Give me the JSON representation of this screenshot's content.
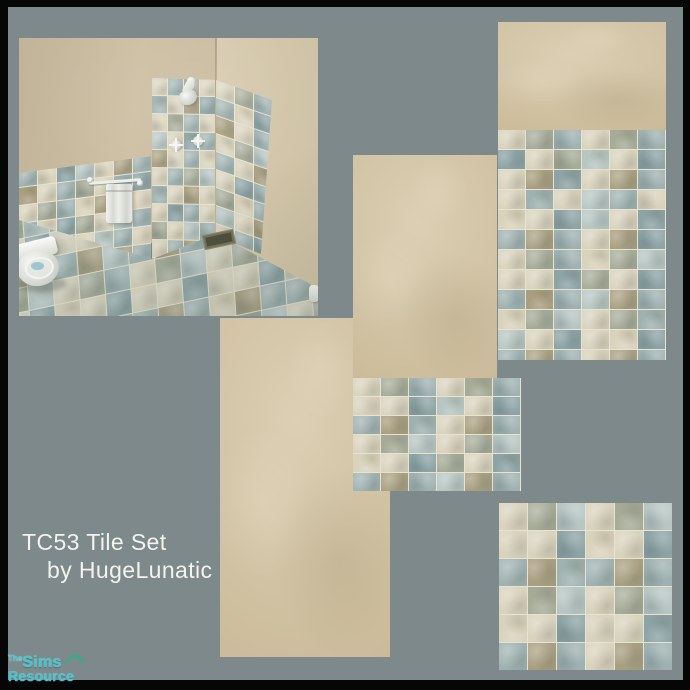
{
  "card": {
    "background_color": "#7d898a",
    "border_color": "#060606"
  },
  "title": {
    "line1": "TC53 Tile Set",
    "line2": "by HugeLunatic",
    "color": "#f3f3f0"
  },
  "logo": {
    "prefix": "The",
    "brand": "Sims",
    "suffix": "Resource",
    "text_color": "#3fc6d2",
    "roof_color": "#2fae8c"
  },
  "palette": {
    "c": "#d9d2bc",
    "b": "#9fb2b1",
    "o": "#a99f80",
    "l": "#b7c6c3",
    "d": "#8da3a5",
    "g": "#a6ab98",
    "grout": "#e7e3d3",
    "wall_beige": "#d2c4a5",
    "fixture_white": "#f0f1ee",
    "water_blue": "#9ec7ce",
    "drain_olive": "#75735a"
  },
  "tiles": {
    "wall": {
      "tile_w": 27,
      "tile_h": 19,
      "rows": [
        "cgbcgb",
        "dcglcd",
        "codcob",
        "cbclbc",
        "ccdlcd",
        "bobcod",
        "cgbcgl",
        "ccdgcd",
        "boblob",
        "cglcgb",
        "lcdccd",
        "bobcob"
      ]
    },
    "wall_small": {
      "tile_w": 27,
      "tile_h": 18,
      "rows": [
        "cgbcgb",
        "ccdlcd",
        "bobcob",
        "cglcgl",
        "ccdgcd",
        "boblob"
      ]
    },
    "floor": {
      "tile_w": 28,
      "tile_h": 27,
      "rows": [
        "cglcgl",
        "ccdccd",
        "bobbob",
        "cglcgl",
        "ccdccd",
        "bobcob"
      ]
    },
    "bath_wainscot": {
      "tile_w": 18,
      "tile_h": 17,
      "rows": [
        "cbocgbc",
        "bcdlcob",
        "ocbgcbd",
        "cgbcolc",
        "bcdgclb",
        "cobclbc",
        "gcbdcob"
      ]
    },
    "bath_shower_left": {
      "tile_w": 15,
      "tile_h": 17,
      "rows": [
        "cbgc",
        "bcod",
        "cgbc",
        "lcdb",
        "ocbc",
        "cbgl",
        "bcoc",
        "cdbc",
        "gclb",
        "cboc",
        "bgcd"
      ]
    },
    "bath_shower_back": {
      "tile_w": 18,
      "tile_h": 17,
      "rows": [
        "cgb",
        "bcd",
        "ocb",
        "cgl",
        "bco",
        "cdb",
        "gcb",
        "lco",
        "cbd",
        "bcg",
        "dcb"
      ]
    },
    "bath_floor": {
      "tile_w": 25,
      "tile_h": 23,
      "rows": [
        "cglbcglcglbcgl",
        "ccdccdccdccdcc",
        "bobbolbobbobbo",
        "cglcgbcglcglcg",
        "ccdccdccdccdcc",
        "boblobbobcobbo",
        "cglcglcglcglcg"
      ]
    }
  }
}
